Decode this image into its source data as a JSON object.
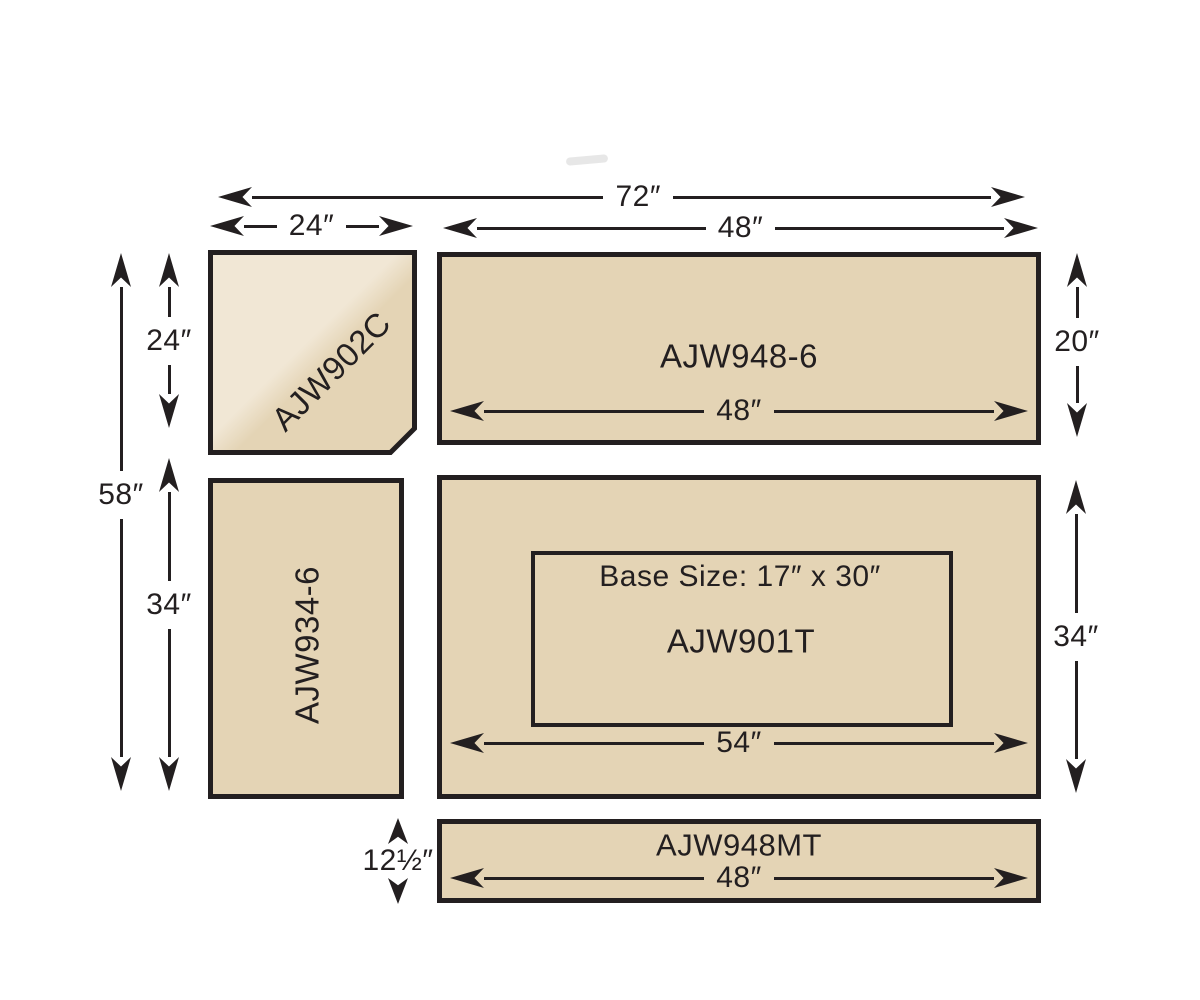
{
  "page": {
    "background": "#ffffff"
  },
  "colors": {
    "ink": "#231f20",
    "fill": "#e4d4b5",
    "fill_light": "#f1e7d5"
  },
  "pieces": {
    "corner_unit": {
      "model": "AJW902C"
    },
    "top_counter": {
      "model": "AJW948-6",
      "inner_width": "48″"
    },
    "left_counter": {
      "model": "AJW934-6"
    },
    "main_counter": {
      "model": "AJW901T",
      "base_size": "Base Size: 17″ x 30″",
      "inner_width": "54″"
    },
    "bottom_rail": {
      "model": "AJW948MT",
      "inner_width": "48″"
    }
  },
  "dimensions": {
    "overall_width": "72″",
    "corner_width": "24″",
    "right_width": "48″",
    "overall_height": "58″",
    "corner_height": "24″",
    "left_lower_height": "34″",
    "right_top_height": "20″",
    "right_main_height": "34″",
    "rail_height": "12½″"
  }
}
